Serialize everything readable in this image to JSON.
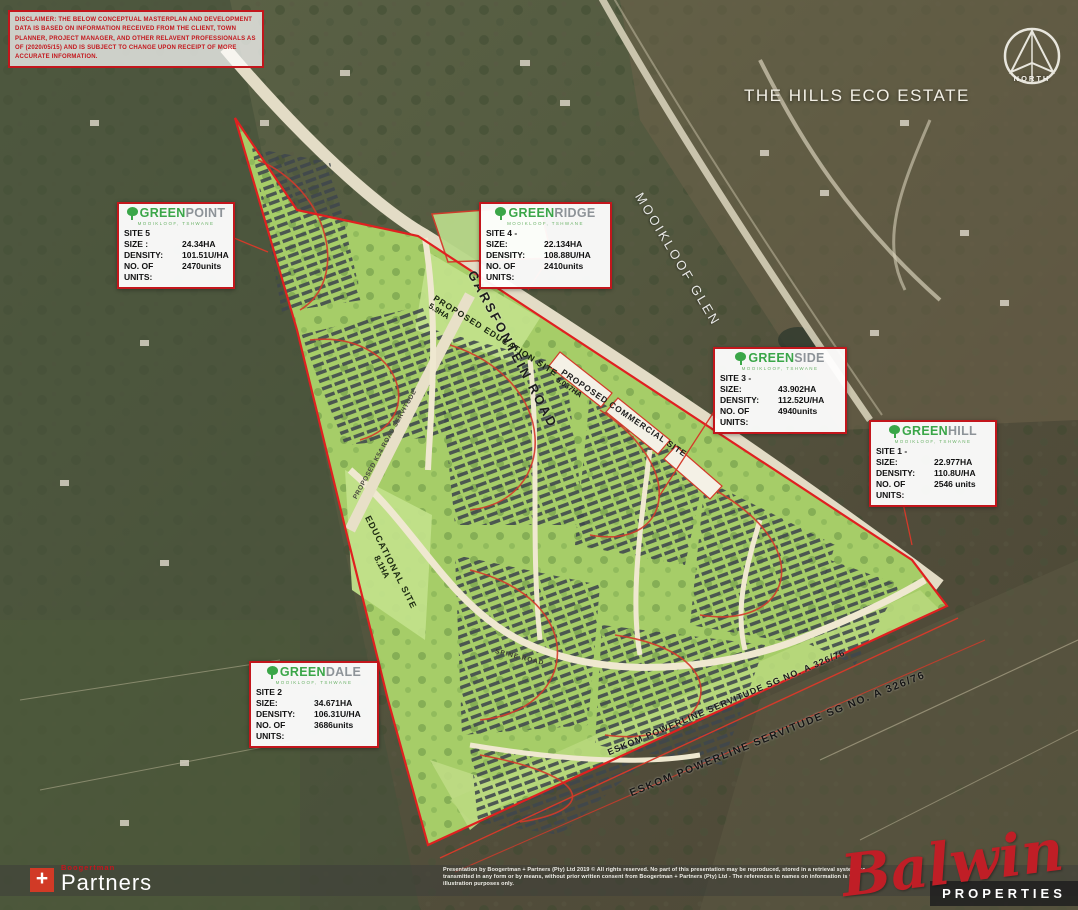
{
  "disclaimer": {
    "text": "DISCLAIMER: THE BELOW CONCEPTUAL MASTERPLAN AND DEVELOPMENT DATA IS BASED ON INFORMATION RECEIVED FROM THE CLIENT, TOWN PLANNER, PROJECT MANAGER, AND OTHER RELAVENT PROFESSIONALS AS OF (2020/05/15) AND IS SUBJECT TO CHANGE UPON RECEIPT OF MORE ACCURATE INFORMATION."
  },
  "compass": {
    "label": "NORTH"
  },
  "area_labels": {
    "hills_estate": "THE HILLS ECO ESTATE",
    "mooikloof_glen": "MOOIKLOOF GLEN",
    "garsfontein_road": "GARSFONTEIN ROAD",
    "proposed_education_site": "PROPOSED EDUCATION SITE",
    "proposed_education_area": "5.9HA",
    "proposed_commercial_site": "PROPOSED COMMERCIAL SITE",
    "proposed_commercial_area": "5.037HA",
    "educational_site": "EDUCATIONAL SITE",
    "educational_site_area": "8.1HA",
    "eskom_servitude_inner": "ESKOM POWERLINE SERVITUDE SG NO. A 326/76",
    "eskom_servitude_outer": "ESKOM POWERLINE SERVITUDE SG NO. A 326/76",
    "k54_servitude": "PROPOSED K54 ROAD SERVITUDE",
    "spine_road": "SPINE ROAD"
  },
  "sites": [
    {
      "brand_prefix": "GREEN",
      "brand_suffix": "POINT",
      "brand_subtitle": "MOOIKLOOF, TSHWANE",
      "site_label": "SITE 5",
      "rows": [
        {
          "label": "SIZE :",
          "value": "24.34HA"
        },
        {
          "label": "DENSITY:",
          "value": "101.51U/HA"
        },
        {
          "label": "NO. OF UNITS:",
          "value": "2470units"
        }
      ]
    },
    {
      "brand_prefix": "GREEN",
      "brand_suffix": "RIDGE",
      "brand_subtitle": "MOOIKLOOF, TSHWANE",
      "site_label": "SITE 4 -",
      "rows": [
        {
          "label": "SIZE:",
          "value": "22.134HA"
        },
        {
          "label": "DENSITY:",
          "value": "108.88U/HA"
        },
        {
          "label": "NO. OF UNITS:",
          "value": "2410units"
        }
      ]
    },
    {
      "brand_prefix": "GREEN",
      "brand_suffix": "SIDE",
      "brand_subtitle": "MOOIKLOOF, TSHWANE",
      "site_label": "SITE 3 -",
      "rows": [
        {
          "label": "SIZE:",
          "value": "43.902HA"
        },
        {
          "label": "DENSITY:",
          "value": "112.52U/HA"
        },
        {
          "label": "NO. OF UNITS:",
          "value": "4940units"
        }
      ]
    },
    {
      "brand_prefix": "GREEN",
      "brand_suffix": "HILL",
      "brand_subtitle": "MOOIKLOOF, TSHWANE",
      "site_label": "SITE 1 -",
      "rows": [
        {
          "label": "SIZE:",
          "value": "22.977HA"
        },
        {
          "label": "DENSITY:",
          "value": "110.8U/HA"
        },
        {
          "label": "NO. OF UNITS:",
          "value": "2546 units"
        }
      ]
    },
    {
      "brand_prefix": "GREEN",
      "brand_suffix": "DALE",
      "brand_subtitle": "MOOIKLOOF, TSHWANE",
      "site_label": "SITE 2",
      "rows": [
        {
          "label": "SIZE:",
          "value": "34.671HA"
        },
        {
          "label": "DENSITY:",
          "value": "106.31U/HA"
        },
        {
          "label": "NO. OF UNITS:",
          "value": "3686units"
        }
      ]
    }
  ],
  "footer": {
    "brand_plus": "+",
    "brand_top": "Boogertman",
    "brand_name": "Partners",
    "copyright": "Presentation by Boogertman + Partners (Pty) Ltd 2019 © All rights reserved. No part of this presentation may be reproduced, stored in a retrieval system, or transmitted in any form or by means, without prior written consent from Boogertman + Partners (Pty) Ltd - The references to names on information is for illustration purposes only."
  },
  "balwin": {
    "script": "Balwin",
    "sub": "PROPERTIES"
  },
  "colors": {
    "accent_red": "#c3161c",
    "brand_green": "#3aa648",
    "site_green": "#a6cd68",
    "boundary_red": "#e02020"
  }
}
